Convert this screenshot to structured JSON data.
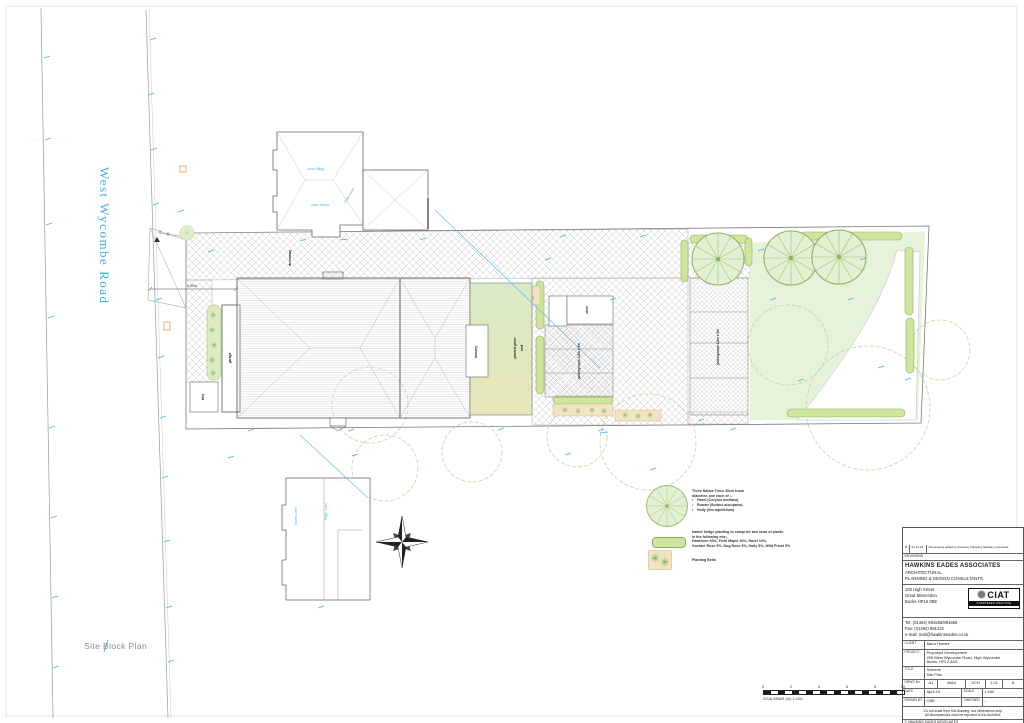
{
  "colors": {
    "annotation_cyan": "#41B0E1",
    "stamp_orange": "#F04E23",
    "hedge_green": "#CFE59E",
    "garden_green": "#E7F2DA",
    "bed_tan": "#F2E3C3"
  },
  "sheet": {
    "plan_title": "Site Block Plan",
    "road_name": "West Wycombe Road"
  },
  "plan": {
    "labels": {
      "driveway": "driveway",
      "garage": "garage",
      "bins": "bins",
      "store": "store",
      "balcony": "balcony",
      "green_roof_line1": "planted green",
      "green_roof_line2": "roof",
      "parking_bays": "parking bays 2.8m x 5m",
      "entrance_dim": "6.59m",
      "ridge_level": "Ridge Level",
      "eaves_level": "Eaves Level"
    }
  },
  "legend": {
    "bullet": "•",
    "tree_lines": [
      "Three Native Trees 30cm trunk",
      "diameter, one each of :-"
    ],
    "tree_items": [
      "Hazel (Corylus avellana)",
      "Rowan (Sorbus aucuparia)",
      "Holly (Ilex aquifolium)"
    ],
    "hedge_lines": [
      "Native hedge planting to comprise two rows of plants",
      "in the following mix:-",
      "Hawthorn 60%, Field Maple 10%, Hazel 10%,",
      "Guelder Rose 5%, Dog Rose 5%, Holly 5%, Wild Privet 5%"
    ],
    "beds_label": "Planting Beds"
  },
  "scalebar": {
    "ticks": [
      "0",
      "2",
      "4",
      "6",
      "8",
      "10"
    ],
    "label": "SCALEBAR (m) 1:100."
  },
  "stamp": {
    "label": "PLANNING DRAWING"
  },
  "titleblock": {
    "revision": {
      "rev": "A",
      "date": "24.12.24",
      "note": "Dimensions added to driveway following highway comments"
    },
    "revisions_label": "REVISIONS",
    "firm_name": "HAWKINS EADES ASSOCIATES",
    "firm_line2": "ARCHITECTURAL",
    "firm_line3": "PLANNING & DESIGN CONSULTANTS",
    "address": [
      "100 High Street",
      "Great Missenden",
      "Bucks HP16 0BE"
    ],
    "contact": [
      "Tel: (01494) 891555/891666",
      "Fax: (01494) 891222",
      "e-mail: mail@hawkinseades.co.uk"
    ],
    "ciat_name": "CIAT",
    "ciat_sub": "CHARTERED PRACTICE",
    "client_label": "CLIENT",
    "client": "Baror Homes",
    "project_label": "PROJECT",
    "project_lines": [
      "Proposed Development",
      "255 West Wycombe Road, High Wycombe",
      "Bucks, HP12 3AS"
    ],
    "title_label": "TITLE",
    "title_lines": [
      "Scheme",
      "Site Plan"
    ],
    "drwg_label": "DRWG No.",
    "drwg_cells": [
      "A1",
      "4664",
      "SCH",
      "1.01",
      "A"
    ],
    "date_label": "DATE",
    "date": "April 24",
    "scale_label": "SCALE",
    "scale": "1:100",
    "drawn_label": "DRAWN BY",
    "drawn": "OSE",
    "checked_label": "CHECKED",
    "checked": "-",
    "disclaimer": [
      "Do not scale from this drawing, use dimensions only.",
      "All discrepancies must be reported to the Architect."
    ],
    "copyright": "© HAWKINS EADES ASSOCIATES"
  }
}
